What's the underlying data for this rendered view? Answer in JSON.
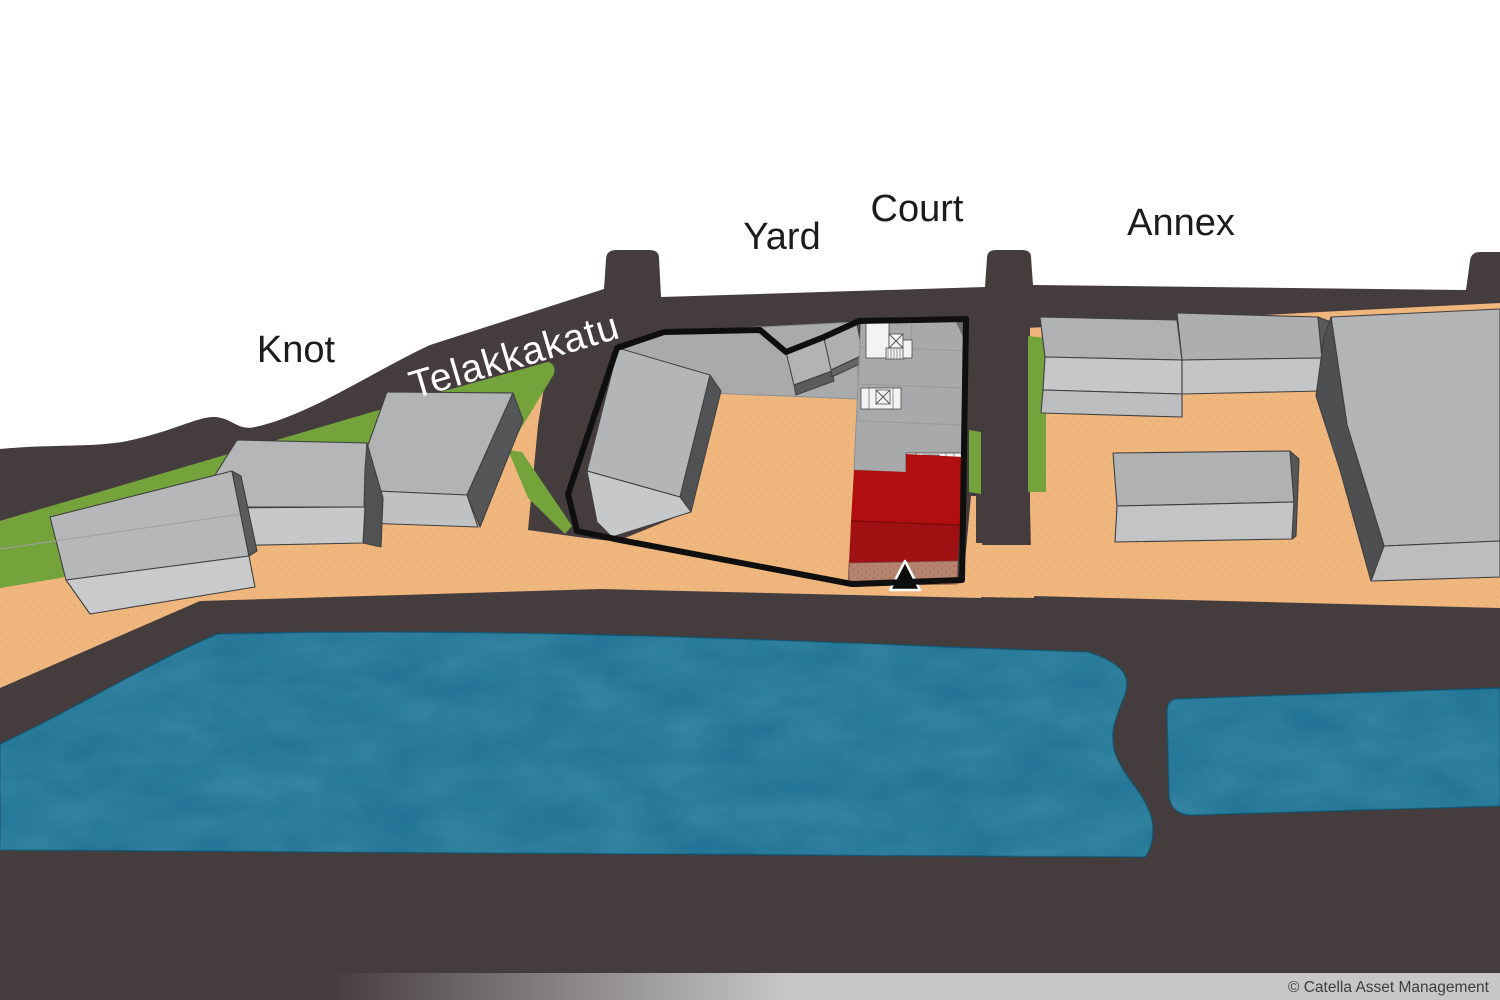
{
  "map": {
    "labels": {
      "knot": "Knot",
      "street": "Telakkakatu",
      "yard": "Yard",
      "court": "Court",
      "annex": "Annex"
    },
    "highlighted_building": {
      "lot": "Court",
      "highlight_color": "#b00d0f",
      "base_strip_color": "#b5836e"
    },
    "entrance_marker": {
      "symbol": "▲",
      "color": "#0d0d0d",
      "outline": "#ffffff"
    },
    "colors": {
      "background": "#ffffff",
      "road": "#453c3e",
      "ground_sand": "#efb77d",
      "grass": "#74a33c",
      "water": "#1e7093",
      "building_roof": "#b3b4b6",
      "building_wall_light": "#c7c8ca",
      "building_wall_dark": "#555658",
      "complex_outline": "#0f0f0f",
      "label_text": "#1c1c1c",
      "street_label_text": "#ffffff"
    }
  },
  "footer": {
    "copyright": "© Catella Asset Management",
    "bar_color": "#c7c7c7"
  }
}
